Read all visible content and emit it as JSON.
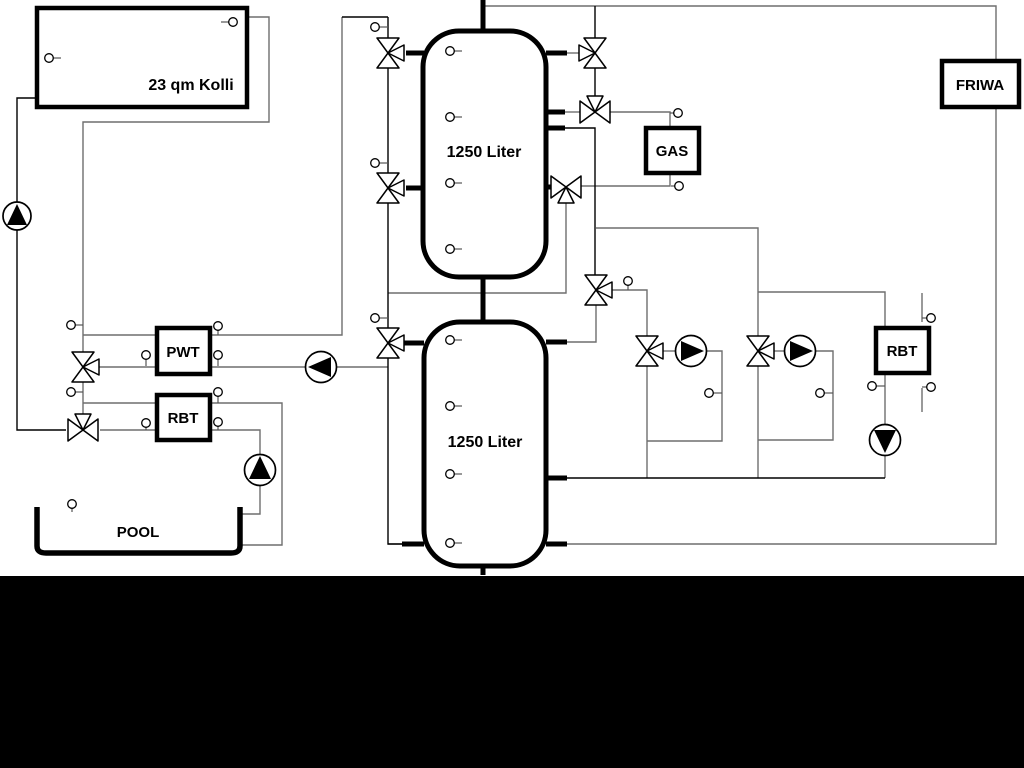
{
  "diagram": {
    "type": "hydraulic-schematic",
    "labels": {
      "collector": "23 qm Kolli",
      "tank1": "1250 Liter",
      "tank2": "1250 Liter",
      "gas": "GAS",
      "friwa": "FRIWA",
      "pwt": "PWT",
      "rbt_left": "RBT",
      "rbt_right": "RBT",
      "pool": "POOL"
    },
    "colors": {
      "background": "#ffffff",
      "bottom_band": "#000000",
      "pipe": "#6e6e6e",
      "pipe_dark": "#000000",
      "symbol_stroke": "#000000",
      "symbol_fill": "#ffffff",
      "label": "#000000"
    }
  }
}
